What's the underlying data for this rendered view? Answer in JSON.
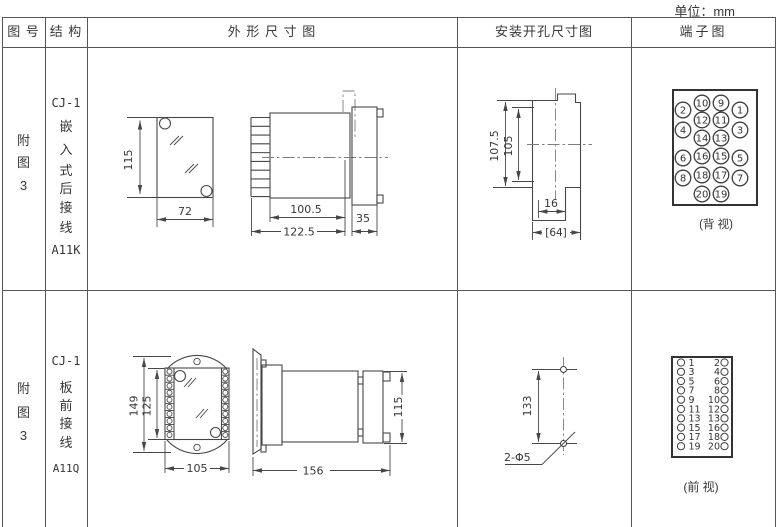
{
  "unit_label": "单位：mm",
  "header": {
    "col_fig_no": "图 号",
    "col_structure": "结 构",
    "col_outline": "外 形 尺 寸 图",
    "col_mounting": "安装开孔尺寸图",
    "col_terminal": "端子图"
  },
  "row1": {
    "fig_no": [
      "附",
      "图",
      "3"
    ],
    "structure": [
      "CJ-1",
      "嵌",
      "入",
      "式",
      "后",
      "接",
      "线",
      "A11K"
    ],
    "outline": {
      "height": "115",
      "width": "72",
      "body_depth": "100.5",
      "total_depth": "122.5",
      "front_depth": "35"
    },
    "mounting": {
      "outer_height": "107.5",
      "hole_height": "105",
      "notch_width": "16",
      "opening_width": "[64]"
    },
    "terminal": {
      "view_label": "(背 视)",
      "numbers": [
        "2",
        "10",
        "9",
        "1",
        "4",
        "12",
        "11",
        "3",
        "14",
        "13",
        "6",
        "16",
        "15",
        "5",
        "8",
        "18",
        "17",
        "7",
        "20",
        "19"
      ]
    }
  },
  "row2": {
    "fig_no": [
      "附",
      "图",
      "3"
    ],
    "structure": [
      "CJ-1",
      "板",
      "前",
      "接",
      "线",
      "A11Q"
    ],
    "outline": {
      "outer_height": "149",
      "inner_height": "125",
      "width": "105",
      "depth": "156",
      "cover_height": "115"
    },
    "mounting": {
      "hole_spacing": "133",
      "hole_label": "2-Φ5"
    },
    "terminal": {
      "view_label": "(前 视)",
      "rows": [
        [
          "1",
          "2"
        ],
        [
          "3",
          "4"
        ],
        [
          "5",
          "6"
        ],
        [
          "7",
          "8"
        ],
        [
          "9",
          "10"
        ],
        [
          "11",
          "12"
        ],
        [
          "13",
          "13"
        ],
        [
          "15",
          "16"
        ],
        [
          "17",
          "18"
        ],
        [
          "19",
          "20"
        ]
      ]
    }
  }
}
